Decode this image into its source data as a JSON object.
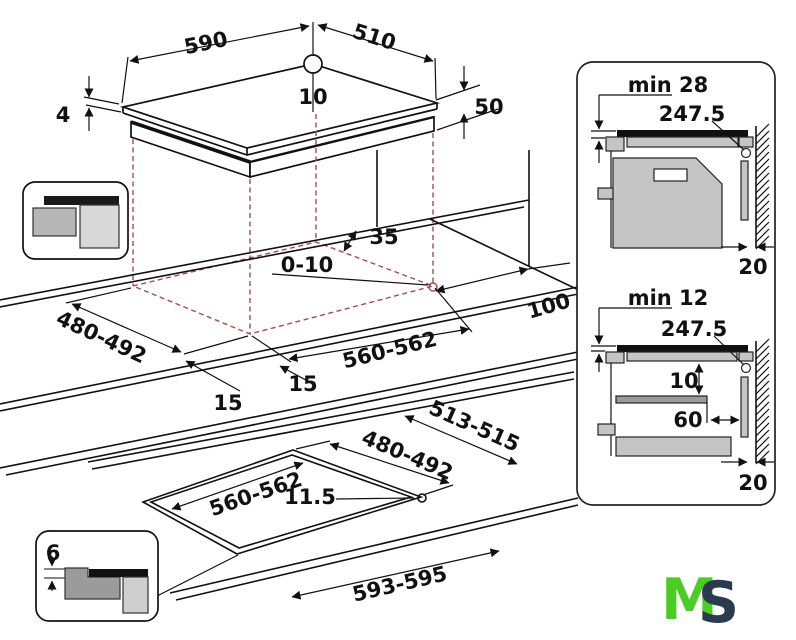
{
  "diagram": {
    "hob": {
      "width": "590",
      "depth": "510",
      "hole_offset": "10",
      "glass_thickness": "4",
      "body_height": "50"
    },
    "worktop": {
      "rear_clearance": "35",
      "corner_radius": "0-10",
      "cutout_width": "480-492",
      "cutout_length": "560-562",
      "front_min": "15",
      "side_min": "15",
      "right_clearance": "100"
    },
    "flush": {
      "cutout_length": "560-562",
      "ledge": "11.5",
      "cutout_width": "480-492",
      "outer_width": "513-515",
      "outer_length": "593-595",
      "recess_depth": "6"
    },
    "panel_top": {
      "title": "min 28",
      "cable": "247.5",
      "wall_gap": "20"
    },
    "panel_bottom": {
      "title": "min 12",
      "cable": "247.5",
      "clearance": "10",
      "setback": "60",
      "wall_gap": "20"
    },
    "logo": {
      "m": "M",
      "s": "S"
    }
  },
  "colors": {
    "line": "#111111",
    "projection_dash": "#a0504a",
    "gray_mid": "#c5c5c5",
    "gray_dark": "#9b9b9b",
    "gray_light": "#d8d8d8",
    "logo_green": "#4ccd23",
    "logo_navy": "#2b3b4f"
  }
}
